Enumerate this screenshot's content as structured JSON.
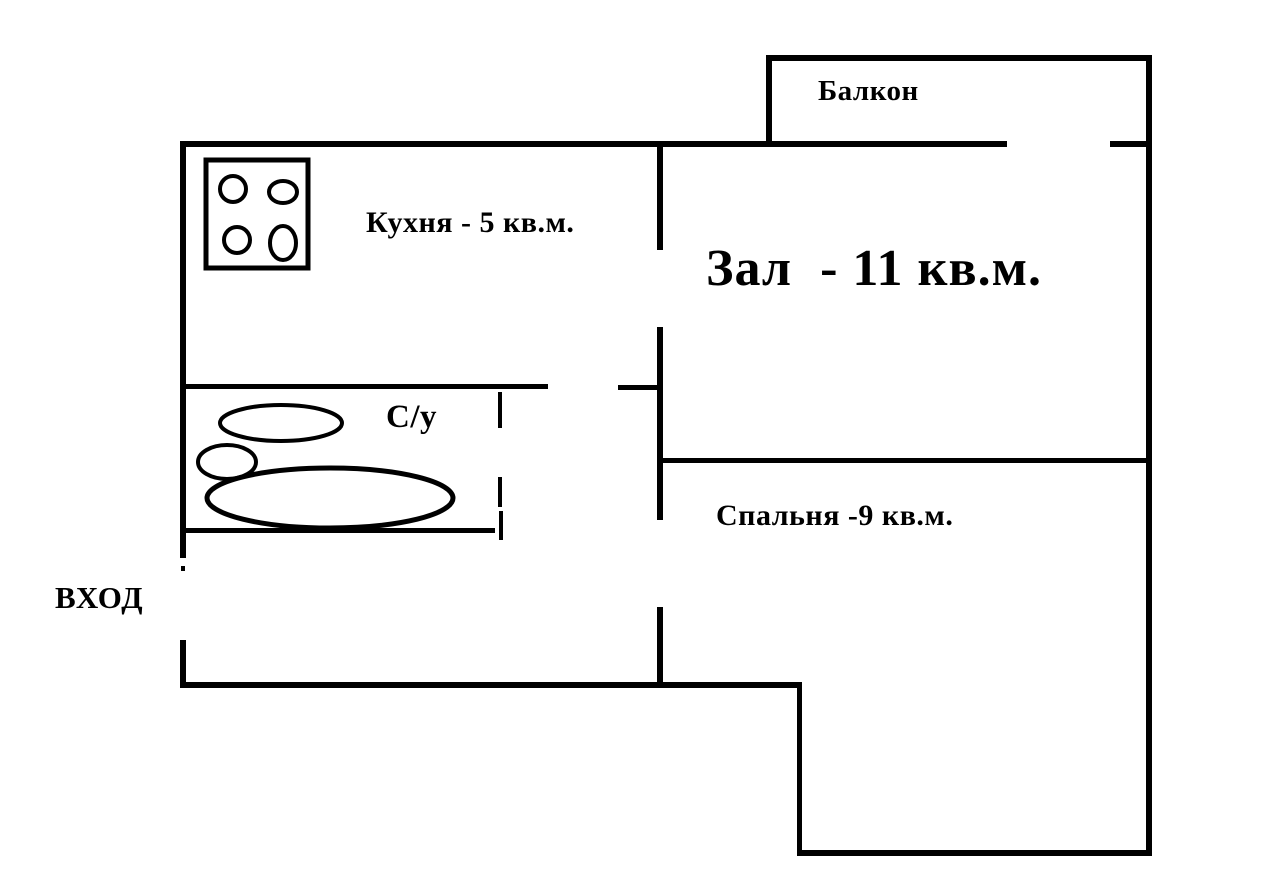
{
  "diagram": {
    "type": "apartment-floor-plan",
    "colors": {
      "wall": "#000000",
      "background": "#ffffff",
      "text": "#000000"
    },
    "labels": {
      "balcony": "Балкон",
      "kitchen": "Кухня - 5 кв.м.",
      "hall": "Зал  - 11 кв.м.",
      "bathroom": "С/у",
      "bedroom": "Спальня -9 кв.м.",
      "entrance": "ВХОД"
    },
    "rooms": [
      {
        "id": "balcony",
        "label": "Балкон"
      },
      {
        "id": "kitchen",
        "label": "Кухня - 5 кв.м.",
        "area_sqm": 5
      },
      {
        "id": "hall",
        "label": "Зал  - 11 кв.м.",
        "area_sqm": 11
      },
      {
        "id": "bathroom",
        "label": "С/у"
      },
      {
        "id": "bedroom",
        "label": "Спальня -9 кв.м.",
        "area_sqm": 9
      },
      {
        "id": "entrance",
        "label": "ВХОД"
      }
    ],
    "fixtures": {
      "kitchen": [
        "stove-four-burners-icon"
      ],
      "bathroom": [
        "sink-oval-icon",
        "toilet-oval-icon",
        "bathtub-oval-icon"
      ]
    }
  }
}
